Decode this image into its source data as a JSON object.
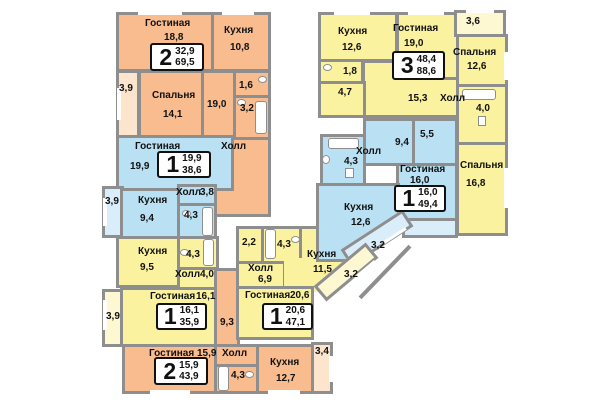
{
  "plan_type": "floor-plan",
  "colors": {
    "wall": "#8e8e8e",
    "orange": "#f8bc8e",
    "blue": "#b9e1f3",
    "yellow": "#faf29f",
    "badge_border": "#111111"
  },
  "common": {
    "corridor_area": "9,3"
  },
  "apartments": [
    {
      "badge": {
        "rooms": "2",
        "living_area": "32,9",
        "total_area": "69,5"
      },
      "living": {
        "name": "Гостиная",
        "area": "18,8"
      },
      "kitchen": {
        "name": "Кухня",
        "area": "10,8"
      },
      "bedroom": {
        "name": "Спальня",
        "area": "14,1"
      },
      "hall": {
        "name": "Холл",
        "area": "19,0"
      },
      "wc": {
        "area": "1,6"
      },
      "bath": {
        "area": "3,2"
      },
      "balcony": {
        "area": "3,9"
      }
    },
    {
      "badge": {
        "rooms": "1",
        "living_area": "19,9",
        "total_area": "38,6"
      },
      "living": {
        "name": "Гостиная",
        "area": "19,9"
      },
      "kitchen": {
        "name": "Кухня",
        "area": "9,4"
      },
      "hall": {
        "name": "Холл",
        "area": "3,8"
      },
      "bath": {
        "area": "4,3"
      },
      "balcony": {
        "area": "3,9"
      }
    },
    {
      "badge": {
        "rooms": "1",
        "living_area": "16,1",
        "total_area": "35,9"
      },
      "kitchen": {
        "name": "Кухня",
        "area": "9,5"
      },
      "bath": {
        "area": "4,3"
      },
      "hall": {
        "name": "Холл",
        "area": "4,0"
      },
      "living": {
        "name": "Гостиная",
        "area": "16,1"
      },
      "balcony": {
        "area": "3,9"
      }
    },
    {
      "badge": {
        "rooms": "1",
        "living_area": "20,6",
        "total_area": "47,1"
      },
      "closet": {
        "area": "2,2"
      },
      "bath": {
        "area": "4,3"
      },
      "hall": {
        "name": "Холл",
        "area": "6,9"
      },
      "kitchen": {
        "name": "Кухня",
        "area": "11,5"
      },
      "living": {
        "name": "Гостиная",
        "area": "20,6"
      },
      "balcony": {
        "area": "3,2"
      }
    },
    {
      "badge": {
        "rooms": "2",
        "living_area": "15,9",
        "total_area": "43,9"
      },
      "living": {
        "name": "Гостиная",
        "area": "15,9"
      },
      "hall": {
        "name": "Холл"
      },
      "bath": {
        "area": "4,3"
      },
      "kitchen": {
        "name": "Кухня",
        "area": "12,7"
      },
      "balcony": {
        "area": "3,4"
      }
    },
    {
      "badge": {
        "rooms": "3",
        "living_area": "48,4",
        "total_area": "88,6"
      },
      "kitchen": {
        "name": "Кухня",
        "area": "12,6"
      },
      "living": {
        "name": "Гостиная",
        "area": "19,0"
      },
      "bedroom1": {
        "name": "Спальня",
        "area": "12,6"
      },
      "bedroom2": {
        "name": "Спальня",
        "area": "16,8"
      },
      "wc": {
        "area": "1,8"
      },
      "corridor": {
        "area": "4,7"
      },
      "hall": {
        "name": "Холл",
        "area": "15,3"
      },
      "bath": {
        "area": "4,0"
      },
      "balcony": {
        "area": "3,6"
      }
    },
    {
      "badge": {
        "rooms": "1",
        "living_area": "16,0",
        "total_area": "49,4"
      },
      "hall": {
        "name": "Холл",
        "area": "9,4"
      },
      "storage": {
        "area": "5,5"
      },
      "bath": {
        "area": "4,3"
      },
      "living": {
        "name": "Гостиная",
        "area": "16,0"
      },
      "kitchen": {
        "name": "Кухня",
        "area": "12,6"
      },
      "balcony": {
        "area": "3,2"
      }
    }
  ]
}
